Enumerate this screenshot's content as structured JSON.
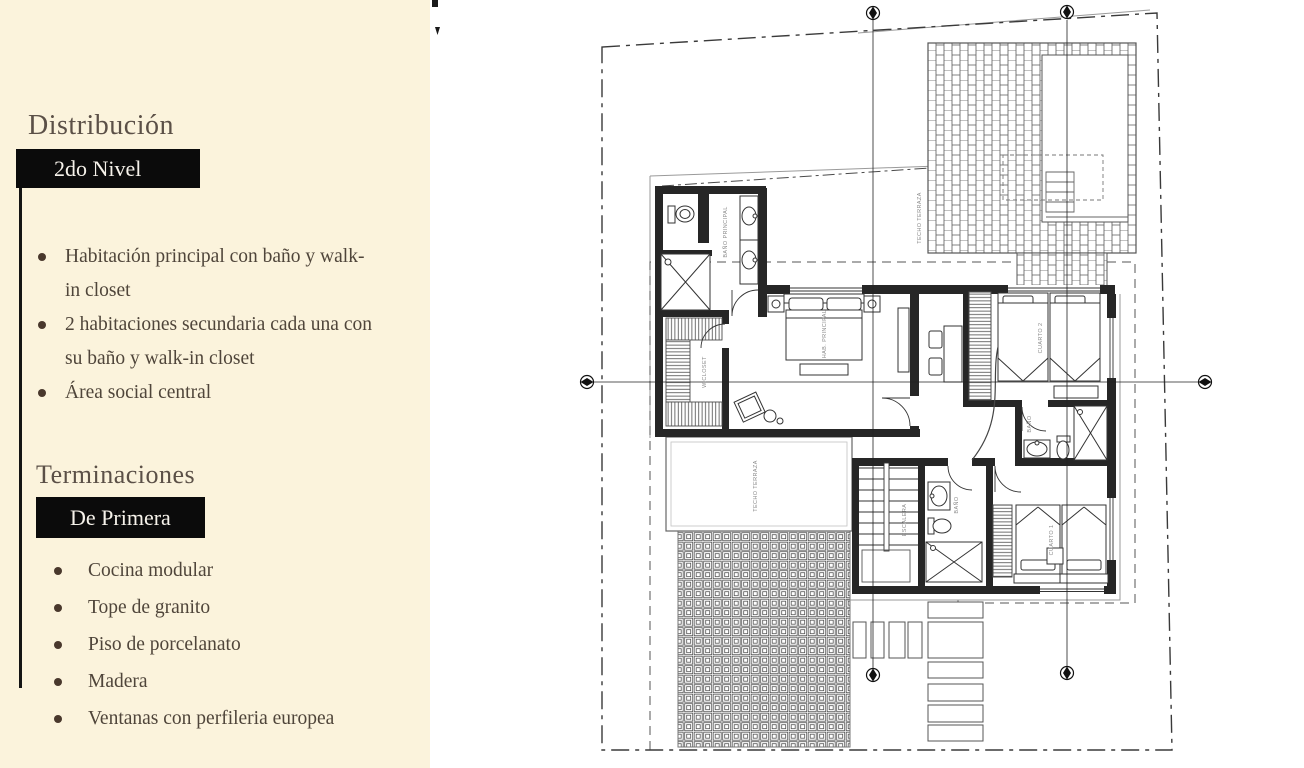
{
  "left_panel": {
    "bg_color": "#fbf3dc",
    "accent_color": "#0b0b0b",
    "sections": [
      {
        "heading": "Distribución",
        "badge": "2do Nivel",
        "bullets": [
          "Habitación principal con baño y walk-in closet",
          "2 habitaciones secundaria cada una con su baño y walk-in closet",
          "Área social central"
        ]
      },
      {
        "heading": "Terminaciones",
        "badge": "De Primera",
        "bullets": [
          "Cocina modular",
          "Tope de granito",
          "Piso de porcelanato",
          "Madera",
          "Ventanas con perfileria europea"
        ]
      }
    ]
  },
  "floor_plan": {
    "labels": {
      "techo_top": "TECHO TERRAZA",
      "bano_principal": "BAÑO PRINCIPAL",
      "hab_principal": "HAB. PRINCIPAL",
      "closet": "W.CLOSET",
      "techo_left": "TECHO TERRAZA",
      "escalera": "ESCALERA",
      "bano_1": "BAÑO",
      "cuarto_2": "CUARTO 2",
      "bano_2": "BAÑO",
      "cuarto_1": "CUARTO 1"
    },
    "colors": {
      "wall": "#262626",
      "boundary": "#3a3a3a",
      "thin_line": "#999999"
    }
  }
}
